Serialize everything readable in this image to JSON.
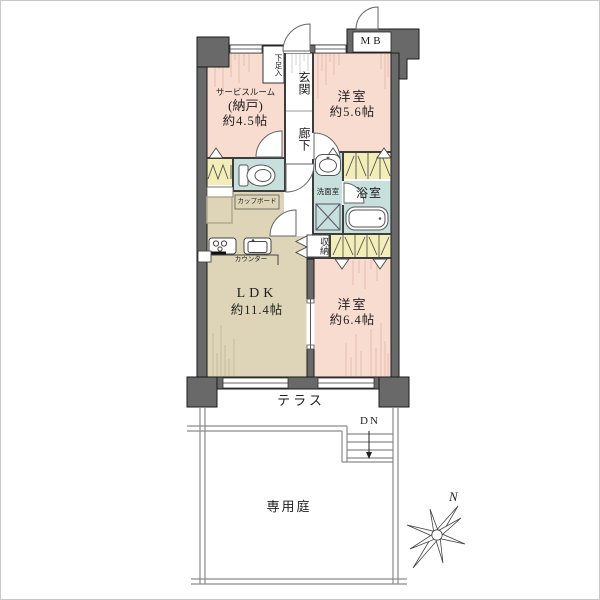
{
  "rooms": {
    "service": {
      "name": "サービスルーム",
      "sub": "(納戸)",
      "size": "約4.5帖"
    },
    "bedroom1": {
      "name": "洋室",
      "size": "約5.6帖"
    },
    "bedroom2": {
      "name": "洋室",
      "size": "約6.4帖"
    },
    "ldk": {
      "name": "LDK",
      "size": "約11.4帖"
    },
    "entrance": {
      "name": "玄関"
    },
    "hallway": {
      "name": "廊下"
    },
    "shoe_cabinet": {
      "name": "下足入"
    },
    "washroom": {
      "name": "洗面室"
    },
    "bathroom": {
      "name": "浴室"
    },
    "storage": {
      "name": "収納"
    }
  },
  "fixtures": {
    "cupboard": "カップボード",
    "counter": "カウンター",
    "meter_box": "MB"
  },
  "outdoor": {
    "terrace": "テラス",
    "garden": "専用庭",
    "stairs_down": "DN"
  },
  "compass": {
    "north": "N"
  },
  "icons": {
    "toilet": "toilet-icon",
    "washbasin": "washbasin-icon",
    "washing_machine": "washing-machine-icon",
    "bathtub": "bathtub-icon",
    "stove": "stove-icon",
    "kitchen_sink": "kitchen-sink-icon",
    "stairs": "stairs-icon",
    "compass_rose": "compass-rose-icon",
    "down_arrow": "down-arrow-icon"
  },
  "colors": {
    "room_pink": "#f8dcd0",
    "room_tan": "#ded5b8",
    "wet_blue": "#c7dfdd",
    "closet_yellow": "#f3edb8",
    "wall_gray": "#696969",
    "line_dark": "#1a1a1a",
    "garden_line": "#8a8a8a"
  }
}
